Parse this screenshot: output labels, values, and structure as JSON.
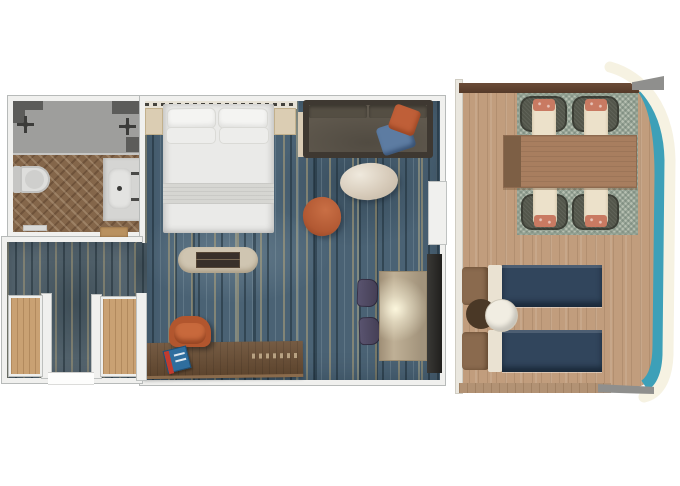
{
  "meta": {
    "type": "floor-plan",
    "description": "Top-down 3D rendered floor plan of a ship cabin suite with private balcony",
    "visible_text": "none"
  },
  "rooms": {
    "bathroom": {
      "label": "Bathroom"
    },
    "bedroom": {
      "label": "Bedroom and living area"
    },
    "hall": {
      "label": "Entry hall"
    },
    "balcony": {
      "label": "Private balcony"
    }
  },
  "furniture": {
    "shower": "Walk-in shower",
    "shower_valve": "Shower control valve",
    "toilet": "Toilet",
    "vanity": "Vanity with sink",
    "bath_mat": "Bath mat",
    "bath_threshold": "Bathroom door threshold",
    "headboard": "Headboard accent wall",
    "nightstand": "Nightstand",
    "bed": "King bed with pillows",
    "pillow": "Bed pillow",
    "fold": "Folded blanket",
    "bench": "Foot-of-bed bench",
    "sofa": "Sofa",
    "sofa_pillow_orange": "Orange throw pillow",
    "sofa_pillow_blue": "Blue throw pillow",
    "sofa_side_table": "Sofa side table",
    "coffee_table": "Oval coffee table",
    "tub_chair": "Orange swivel tub chair",
    "desk": "Writing desk",
    "desk_chair": "Desk chair",
    "magazine": "Magazine",
    "accent_chair": "Accent chair",
    "console_table": "Lit console table",
    "tv_cabinet": "TV cabinet",
    "wardrobe": "Wardrobe closet",
    "entry_door": "Cabin entry door opening",
    "balcony_door": "Balcony door recess",
    "outdoor_table": "Balcony dining table",
    "outdoor_chair": "Balcony dining chair",
    "outdoor_rug": "Checkered outdoor rug",
    "lounger": "Sun lounger",
    "side_table": "Round side table",
    "railing": "Balcony railing (teal)",
    "hull": "Ship hull edge"
  },
  "palette": {
    "background": "#ffffff",
    "wall": "#f0f0ee",
    "wall_outline": "#b7bab9",
    "carpet_base": "#4a6274",
    "carpet_streak": "#baa87a",
    "herringbone_floor": "#84664a",
    "deck_wood": "#c19d7d",
    "outdoor_rug": "#b7c0b2",
    "teal_railing": "#3da0b8",
    "hull_edge": "#f6f2e2",
    "lounger_navy": "#31455c",
    "accent_orange": "#b25933",
    "pillow_blue": "#5d7ca2",
    "sofa_seat": "#5f584d",
    "desk_wood": "#6a4e34",
    "coffee_table_cream": "#d7cbba",
    "dining_table": "#a87e5f",
    "chair_shell": "#53564b",
    "chair_cushion": "#ece1ca",
    "chair_pillow": "#c97a62"
  }
}
